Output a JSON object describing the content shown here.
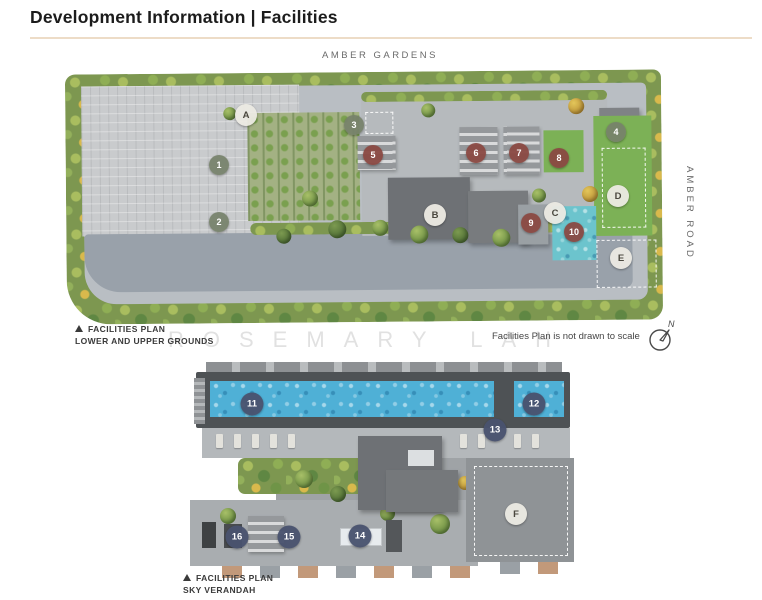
{
  "header": {
    "title": "Development Information | Facilities"
  },
  "roads": {
    "top": "AMBER GARDENS",
    "right": "AMBER ROAD"
  },
  "watermark": "ROSEMARY LAH",
  "footnote": "Facilities Plan is not drawn to scale",
  "compass": {
    "label": "N"
  },
  "colors": {
    "divider": "#eddcc7",
    "marker_green": "#76816a",
    "marker_red": "#8a4942",
    "marker_blue": "#49526e",
    "marker_letter_bg": "#ece9e3",
    "pool_blue": "#56b2d4",
    "lawn_green": "#7cb156"
  },
  "plan_lower": {
    "caption_title": "FACILITIES PLAN",
    "caption_subtitle": "LOWER AND UPPER GROUNDS",
    "markers": [
      {
        "label": "A",
        "kind": "letter",
        "x": 182,
        "y": 45
      },
      {
        "label": "B",
        "kind": "letter",
        "x": 371,
        "y": 145
      },
      {
        "label": "C",
        "kind": "letter",
        "x": 491,
        "y": 143
      },
      {
        "label": "D",
        "kind": "letter",
        "x": 554,
        "y": 126
      },
      {
        "label": "E",
        "kind": "letter",
        "x": 557,
        "y": 188
      },
      {
        "label": "1",
        "kind": "green",
        "x": 155,
        "y": 95
      },
      {
        "label": "2",
        "kind": "green",
        "x": 155,
        "y": 152
      },
      {
        "label": "3",
        "kind": "green",
        "x": 290,
        "y": 55
      },
      {
        "label": "4",
        "kind": "green",
        "x": 552,
        "y": 62
      },
      {
        "label": "5",
        "kind": "red",
        "x": 309,
        "y": 85
      },
      {
        "label": "6",
        "kind": "red",
        "x": 412,
        "y": 83
      },
      {
        "label": "7",
        "kind": "red",
        "x": 455,
        "y": 83
      },
      {
        "label": "8",
        "kind": "red",
        "x": 495,
        "y": 88
      },
      {
        "label": "9",
        "kind": "red",
        "x": 467,
        "y": 153
      },
      {
        "label": "10",
        "kind": "red",
        "x": 510,
        "y": 162
      }
    ]
  },
  "plan_sky": {
    "caption_title": "FACILITIES PLAN",
    "caption_subtitle": "SKY VERANDAH",
    "markers": [
      {
        "label": "11",
        "kind": "blue",
        "x": 72,
        "y": 44
      },
      {
        "label": "12",
        "kind": "blue",
        "x": 354,
        "y": 44
      },
      {
        "label": "13",
        "kind": "blue",
        "x": 315,
        "y": 70
      },
      {
        "label": "14",
        "kind": "blue",
        "x": 180,
        "y": 176
      },
      {
        "label": "15",
        "kind": "blue",
        "x": 109,
        "y": 177
      },
      {
        "label": "16",
        "kind": "blue",
        "x": 57,
        "y": 177
      },
      {
        "label": "F",
        "kind": "letter",
        "x": 336,
        "y": 154
      }
    ]
  }
}
